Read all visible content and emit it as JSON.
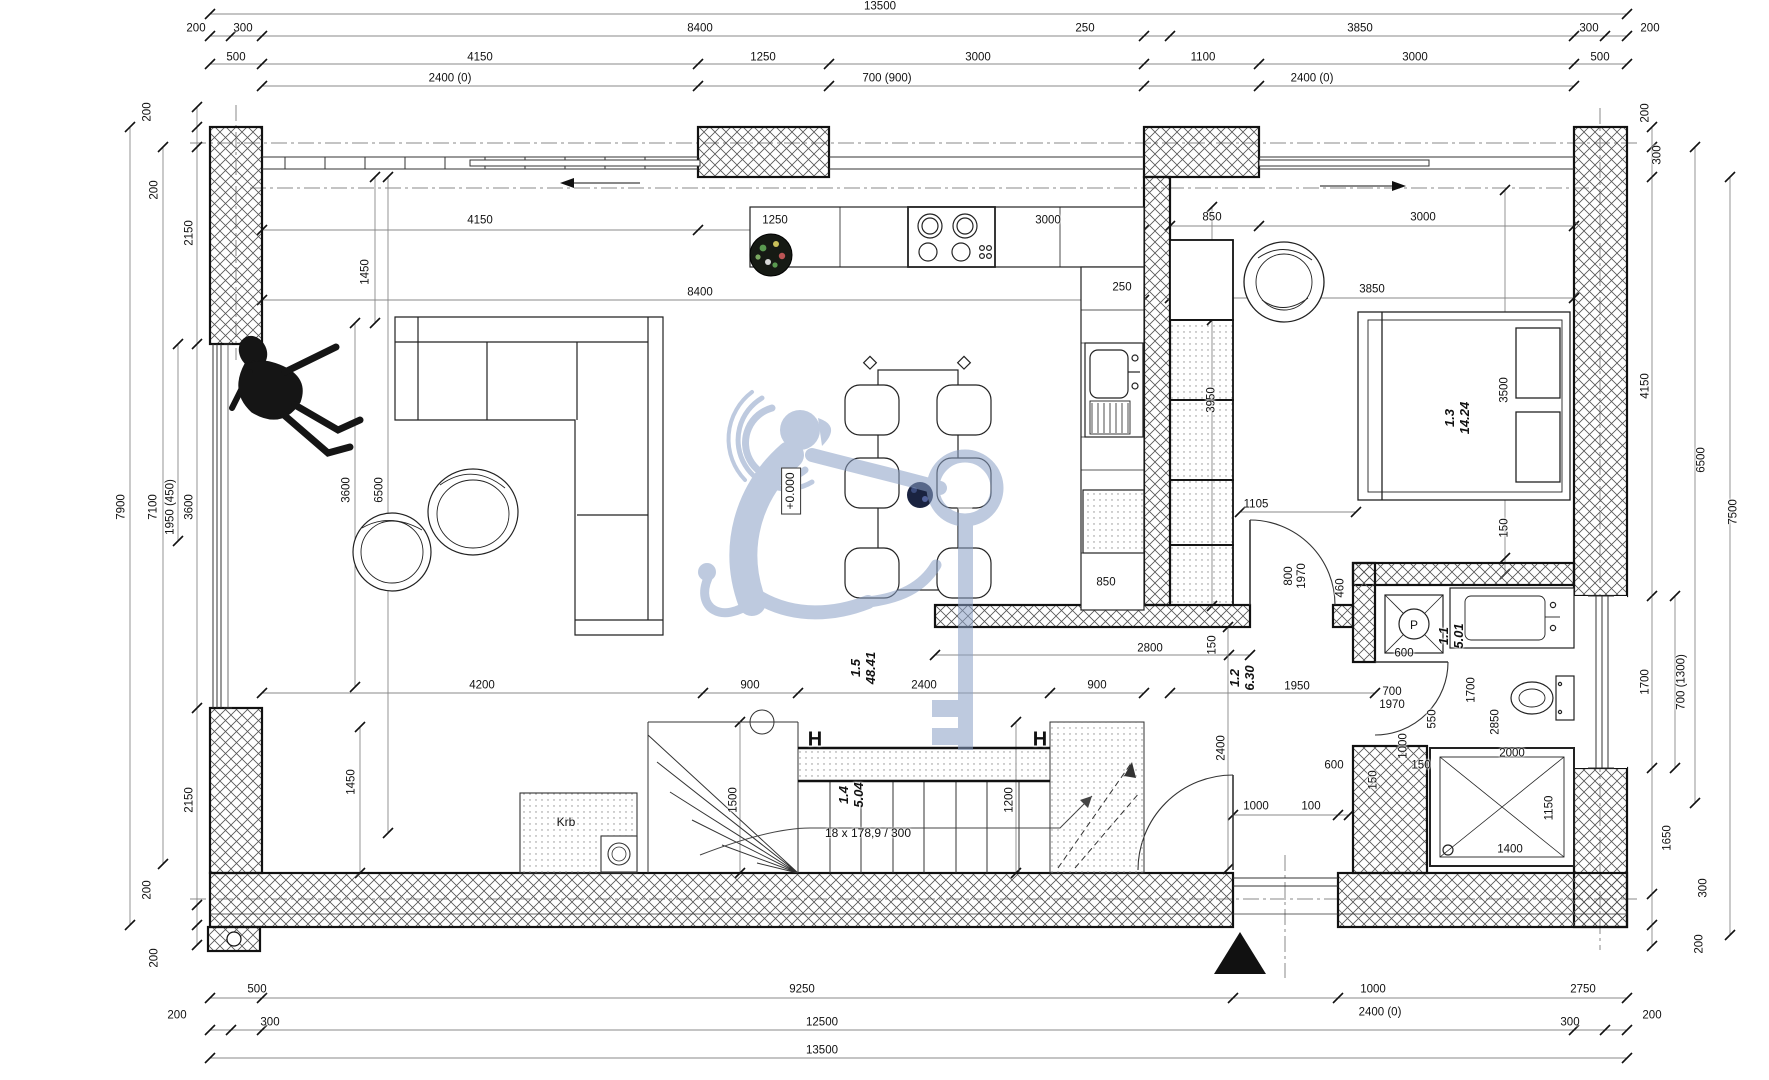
{
  "drawing": {
    "type": "architectural-floor-plan",
    "level_elevation": "+0.000",
    "north_arrow": true,
    "colors": {
      "line": "#111111",
      "dim_line": "#777777",
      "watermark": "#8aa0c5"
    },
    "rooms": [
      {
        "number": "1.1",
        "area": "5.01"
      },
      {
        "number": "1.2",
        "area": "6.30"
      },
      {
        "number": "1.3",
        "area": "14.24"
      },
      {
        "number": "1.4",
        "area": "5.04"
      },
      {
        "number": "1.5",
        "area": "48.41"
      }
    ],
    "stair_note": "18 x 178,9 / 300",
    "fireplace_label": "Krb"
  },
  "labels": [
    {
      "t": "13500",
      "x": 880,
      "y": 7
    },
    {
      "t": "200",
      "x": 196,
      "y": 29
    },
    {
      "t": "300",
      "x": 243,
      "y": 29
    },
    {
      "t": "8400",
      "x": 700,
      "y": 29
    },
    {
      "t": "250",
      "x": 1085,
      "y": 29
    },
    {
      "t": "3850",
      "x": 1360,
      "y": 29
    },
    {
      "t": "300",
      "x": 1589,
      "y": 29
    },
    {
      "t": "200",
      "x": 1650,
      "y": 29
    },
    {
      "t": "500",
      "x": 236,
      "y": 58
    },
    {
      "t": "4150",
      "x": 480,
      "y": 58
    },
    {
      "t": "1250",
      "x": 763,
      "y": 58
    },
    {
      "t": "3000",
      "x": 978,
      "y": 58
    },
    {
      "t": "1100",
      "x": 1203,
      "y": 58
    },
    {
      "t": "3000",
      "x": 1415,
      "y": 58
    },
    {
      "t": "500",
      "x": 1600,
      "y": 58
    },
    {
      "t": "2400 (0)",
      "x": 450,
      "y": 79
    },
    {
      "t": "700 (900)",
      "x": 887,
      "y": 79
    },
    {
      "t": "2400 (0)",
      "x": 1312,
      "y": 79
    },
    {
      "t": "500",
      "x": 257,
      "y": 990
    },
    {
      "t": "9250",
      "x": 802,
      "y": 990
    },
    {
      "t": "1000",
      "x": 1373,
      "y": 990
    },
    {
      "t": "2750",
      "x": 1583,
      "y": 990
    },
    {
      "t": "2400 (0)",
      "x": 1380,
      "y": 1013
    },
    {
      "t": "200",
      "x": 177,
      "y": 1016
    },
    {
      "t": "300",
      "x": 270,
      "y": 1023
    },
    {
      "t": "12500",
      "x": 822,
      "y": 1023
    },
    {
      "t": "300",
      "x": 1570,
      "y": 1023
    },
    {
      "t": "200",
      "x": 1652,
      "y": 1016
    },
    {
      "t": "13500",
      "x": 822,
      "y": 1051
    },
    {
      "t": "200",
      "x": 148,
      "y": 112,
      "r": 1
    },
    {
      "t": "200",
      "x": 155,
      "y": 190,
      "r": 1
    },
    {
      "t": "2150",
      "x": 190,
      "y": 233,
      "r": 1
    },
    {
      "t": "3600",
      "x": 190,
      "y": 507,
      "r": 1
    },
    {
      "t": "1950 (450)",
      "x": 171,
      "y": 507,
      "r": 1
    },
    {
      "t": "7100",
      "x": 154,
      "y": 507,
      "r": 1
    },
    {
      "t": "7900",
      "x": 122,
      "y": 507,
      "r": 1
    },
    {
      "t": "2150",
      "x": 190,
      "y": 800,
      "r": 1
    },
    {
      "t": "200",
      "x": 148,
      "y": 890,
      "r": 1
    },
    {
      "t": "200",
      "x": 155,
      "y": 958,
      "r": 1
    },
    {
      "t": "200",
      "x": 1646,
      "y": 113,
      "r": 1
    },
    {
      "t": "300",
      "x": 1658,
      "y": 155,
      "r": 1
    },
    {
      "t": "4150",
      "x": 1646,
      "y": 386,
      "r": 1
    },
    {
      "t": "6500",
      "x": 1702,
      "y": 460,
      "r": 1
    },
    {
      "t": "7500",
      "x": 1734,
      "y": 512,
      "r": 1
    },
    {
      "t": "700 (1300)",
      "x": 1682,
      "y": 682,
      "r": 1
    },
    {
      "t": "1700",
      "x": 1646,
      "y": 682,
      "r": 1
    },
    {
      "t": "1650",
      "x": 1668,
      "y": 838,
      "r": 1
    },
    {
      "t": "300",
      "x": 1704,
      "y": 888,
      "r": 1
    },
    {
      "t": "200",
      "x": 1700,
      "y": 944,
      "r": 1
    },
    {
      "t": "4150",
      "x": 480,
      "y": 221
    },
    {
      "t": "1250",
      "x": 775,
      "y": 221
    },
    {
      "t": "3000",
      "x": 1048,
      "y": 221
    },
    {
      "t": "850",
      "x": 1212,
      "y": 218
    },
    {
      "t": "3000",
      "x": 1423,
      "y": 218
    },
    {
      "t": "8400",
      "x": 700,
      "y": 293
    },
    {
      "t": "250",
      "x": 1122,
      "y": 288
    },
    {
      "t": "3850",
      "x": 1372,
      "y": 290
    },
    {
      "t": "1450",
      "x": 366,
      "y": 272,
      "r": 1
    },
    {
      "t": "3600",
      "x": 347,
      "y": 490,
      "r": 1
    },
    {
      "t": "6500",
      "x": 380,
      "y": 490,
      "r": 1
    },
    {
      "t": "3950",
      "x": 1212,
      "y": 400,
      "r": 1
    },
    {
      "t": "850",
      "x": 1106,
      "y": 583
    },
    {
      "t": "2800",
      "x": 1150,
      "y": 649
    },
    {
      "t": "150",
      "x": 1213,
      "y": 645,
      "r": 1
    },
    {
      "t": "1105",
      "x": 1256,
      "y": 505
    },
    {
      "t": "800\n1970",
      "x": 1296,
      "y": 576,
      "r": 1
    },
    {
      "t": "460",
      "x": 1341,
      "y": 588,
      "r": 1
    },
    {
      "t": "3500",
      "x": 1505,
      "y": 390,
      "r": 1
    },
    {
      "t": "150",
      "x": 1505,
      "y": 528,
      "r": 1
    },
    {
      "t": "1950",
      "x": 1297,
      "y": 687
    },
    {
      "t": "2400",
      "x": 1222,
      "y": 748,
      "r": 1
    },
    {
      "t": "600",
      "x": 1404,
      "y": 654
    },
    {
      "t": "700\n1970",
      "x": 1392,
      "y": 699
    },
    {
      "t": "550",
      "x": 1433,
      "y": 719,
      "r": 1
    },
    {
      "t": "2000",
      "x": 1512,
      "y": 754
    },
    {
      "t": "1700",
      "x": 1472,
      "y": 690,
      "r": 1
    },
    {
      "t": "2850",
      "x": 1496,
      "y": 722,
      "r": 1
    },
    {
      "t": "1150",
      "x": 1550,
      "y": 808,
      "r": 1
    },
    {
      "t": "1400",
      "x": 1510,
      "y": 850
    },
    {
      "t": "1000",
      "x": 1256,
      "y": 807
    },
    {
      "t": "100",
      "x": 1311,
      "y": 807
    },
    {
      "t": "150",
      "x": 1374,
      "y": 780,
      "r": 1
    },
    {
      "t": "1000",
      "x": 1404,
      "y": 746,
      "r": 1
    },
    {
      "t": "600",
      "x": 1334,
      "y": 766
    },
    {
      "t": "150",
      "x": 1421,
      "y": 766
    },
    {
      "t": "4200",
      "x": 482,
      "y": 686
    },
    {
      "t": "900",
      "x": 750,
      "y": 686
    },
    {
      "t": "2400",
      "x": 924,
      "y": 686
    },
    {
      "t": "900",
      "x": 1097,
      "y": 686
    },
    {
      "t": "1500",
      "x": 734,
      "y": 800,
      "r": 1
    },
    {
      "t": "1200",
      "x": 1010,
      "y": 800,
      "r": 1
    },
    {
      "t": "1450",
      "x": 352,
      "y": 782,
      "r": 1
    },
    {
      "t": "1.5\n48.41",
      "x": 864,
      "y": 668,
      "r": 1,
      "k": "room"
    },
    {
      "t": "1.4\n5.04",
      "x": 852,
      "y": 795,
      "r": 1,
      "k": "room"
    },
    {
      "t": "1.3\n14.24",
      "x": 1458,
      "y": 418,
      "r": 1,
      "k": "room"
    },
    {
      "t": "1.2\n6.30",
      "x": 1243,
      "y": 678,
      "r": 1,
      "k": "room"
    },
    {
      "t": "1.1\n5.01",
      "x": 1452,
      "y": 636,
      "r": 1,
      "k": "room"
    },
    {
      "t": "18 x 178,9 / 300",
      "x": 868,
      "y": 834,
      "k": "note"
    },
    {
      "t": "Krb",
      "x": 566,
      "y": 823,
      "k": "note"
    },
    {
      "t": "H",
      "x": 815,
      "y": 740,
      "k": "H"
    },
    {
      "t": "H",
      "x": 1040,
      "y": 740,
      "k": "H"
    },
    {
      "t": "+0.000",
      "x": 791,
      "y": 491,
      "r": 1,
      "k": "elev"
    }
  ]
}
